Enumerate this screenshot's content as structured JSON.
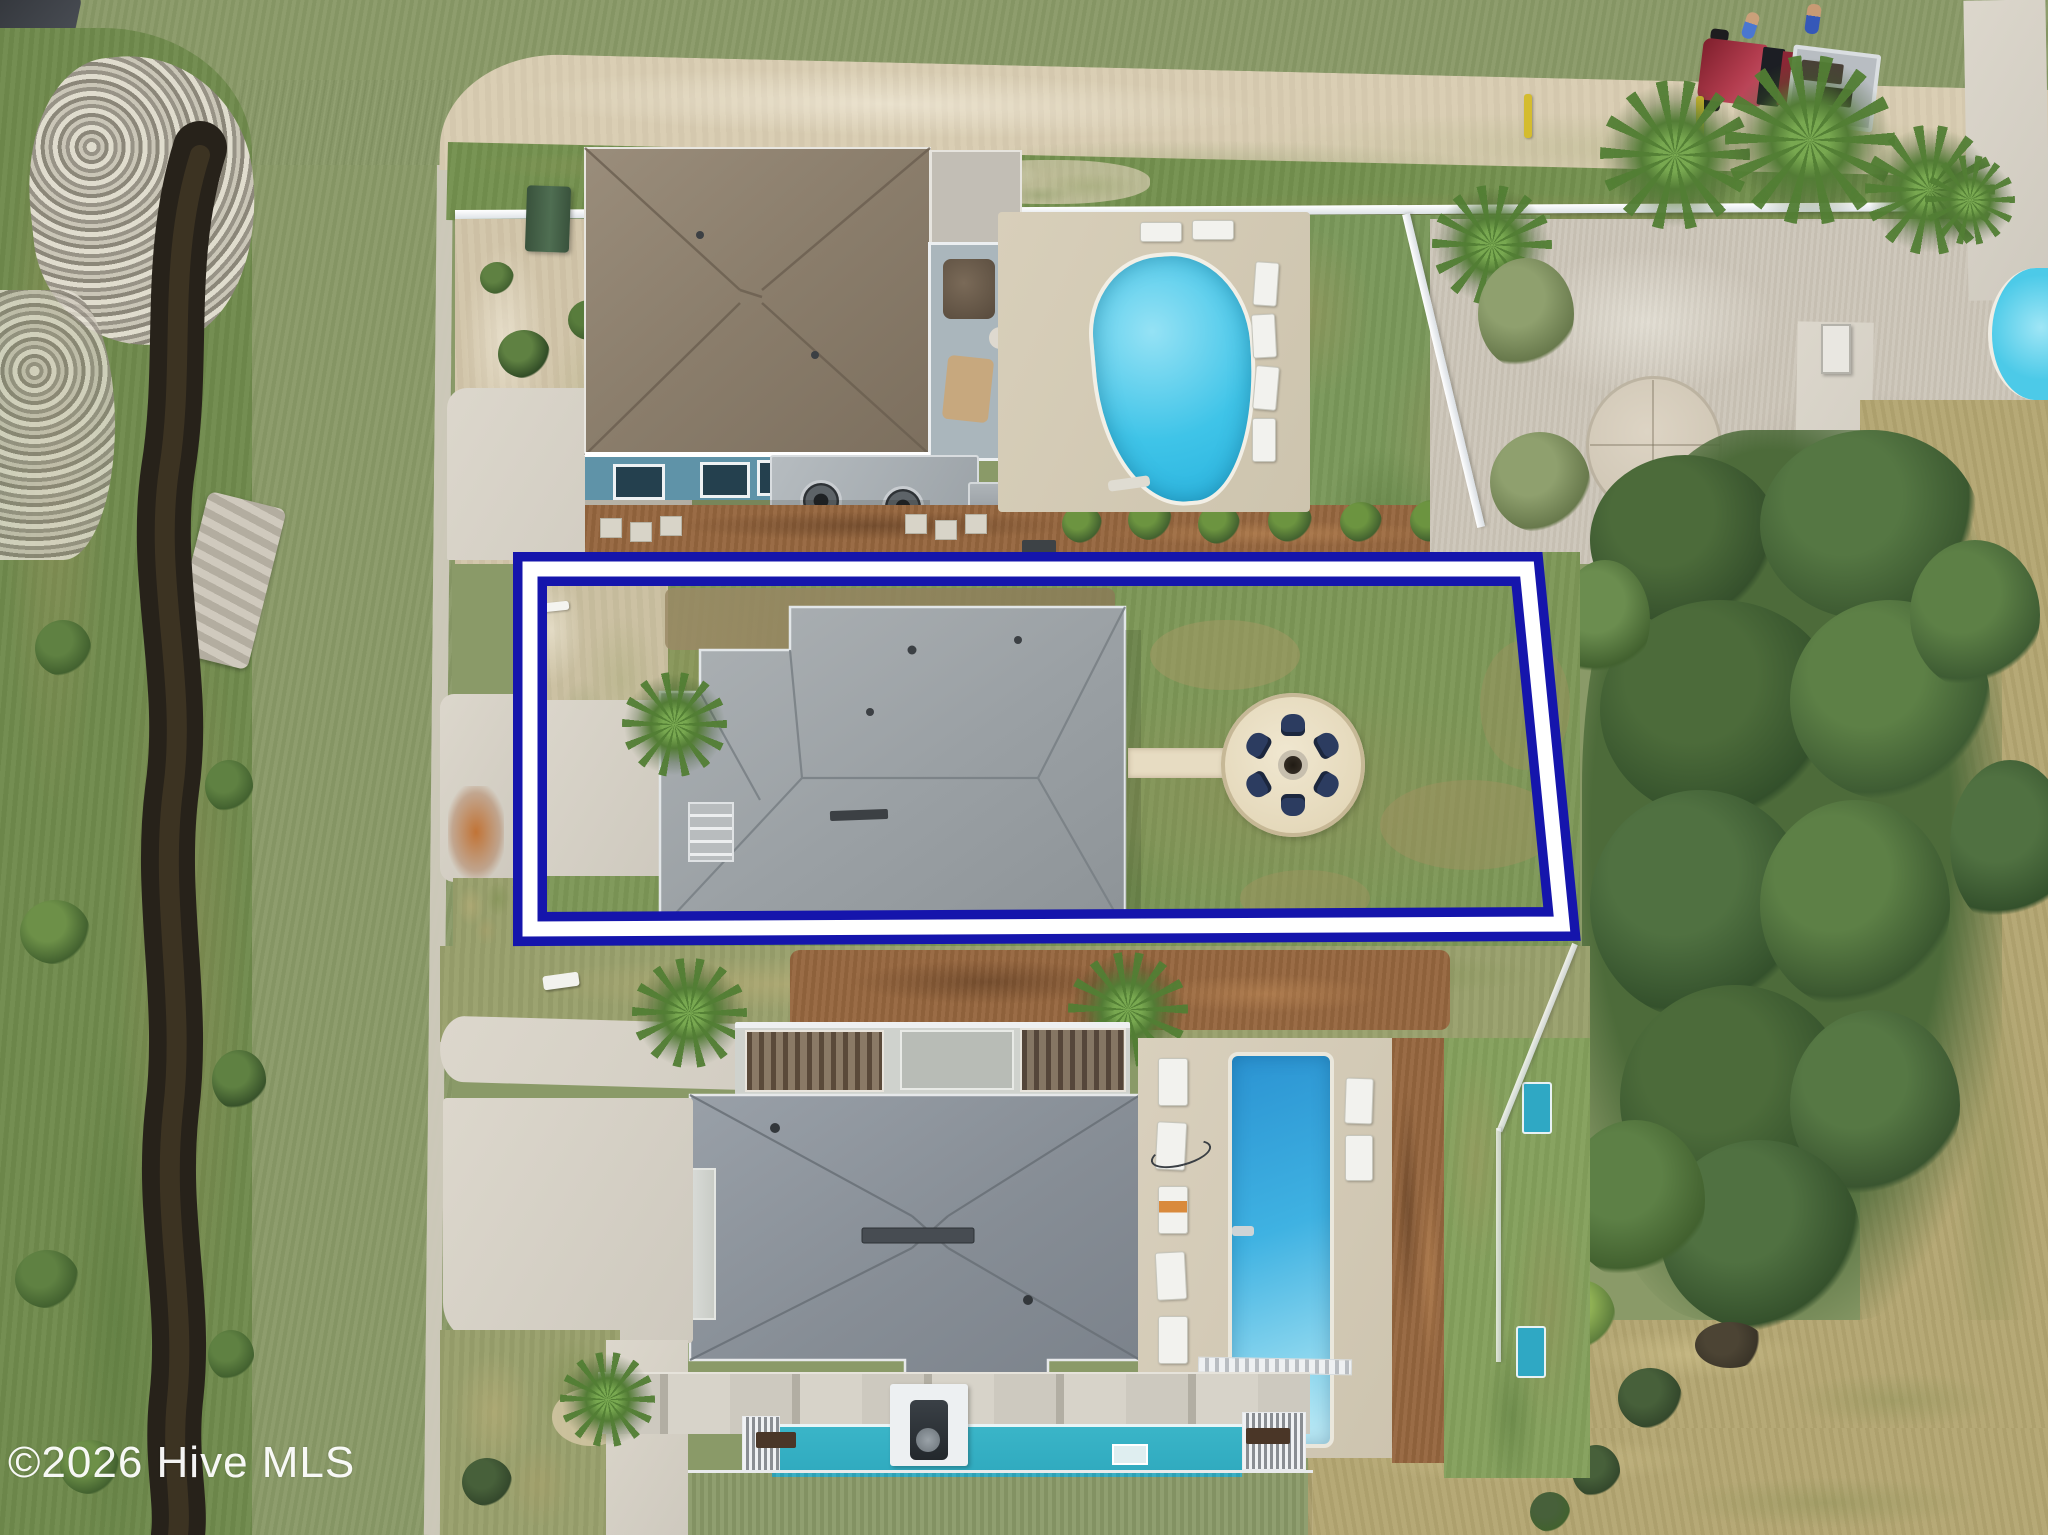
{
  "watermark": {
    "text": "©2026 Hive MLS",
    "color": "#ffffff"
  },
  "annotation": {
    "name": "property-boundary-outline",
    "outline_color": "#1515ac",
    "gap_color": "#ffffff"
  },
  "scene": {
    "fire_pit": {
      "chair_count": 6,
      "chair_color": "#2c3c60",
      "patio_color": "#e9dfc6"
    },
    "pools": {
      "kidney_pool_color": "#3fc4e8",
      "lap_pool_color": "#2f9fd8",
      "deck_pool_color": "#35b7c9"
    },
    "truck": {
      "body_color": "#a42a3c"
    },
    "roads": {
      "asphalt_color": "#a49ea0"
    },
    "canal": {
      "water_color": "#27221a"
    }
  }
}
